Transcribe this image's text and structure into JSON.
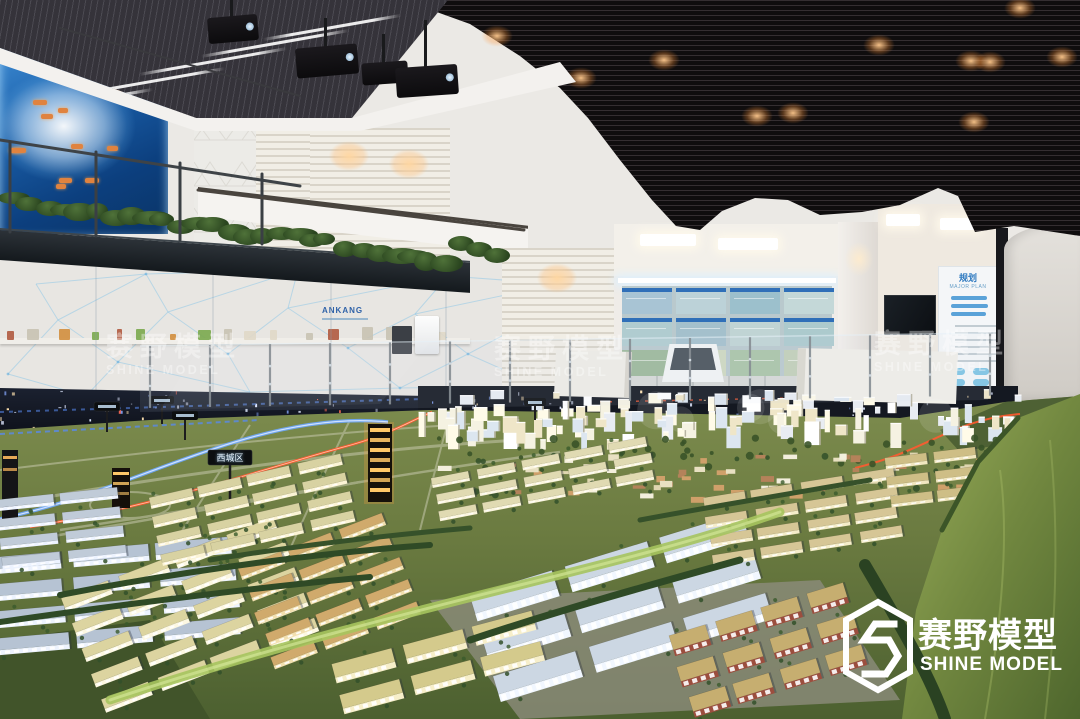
{
  "scene": {
    "description": "Exhibition hall with an illuminated city-planning scale model, mezzanine gallery, blue illuminated China map wall and Shine Model watermarks"
  },
  "watermarks": [
    {
      "zh": "赛野模型",
      "en": "SHINE MODEL"
    },
    {
      "zh": "赛野模型",
      "en": "SHINE MODEL"
    },
    {
      "zh": "赛野模型",
      "en": "SHINE MODEL"
    }
  ],
  "logo": {
    "zh": "赛野模型",
    "en": "SHINE MODEL"
  },
  "wall_text": {
    "ankang": "ANKANG"
  },
  "info_panel": {
    "title": "规划",
    "subtitle": "MAJOR PLAN"
  },
  "model_signs": {
    "district": "西城区"
  },
  "colors": {
    "ceiling_black": "#0f0d0e",
    "wall_white": "#ebe9e5",
    "map_blue": "#1a5ea8",
    "tag_orange": "#e0833f",
    "led_blue": "#6fa8ff",
    "led_red": "#ff5a30",
    "terrain_olive": "#6a7a40",
    "hill_green": "#96aa58"
  },
  "model": {
    "dot_palette": [
      "#dfe8ff",
      "#dfe8ff",
      "#dfe8ff",
      "#dfe8ff",
      "#ffe2b0",
      "#ffe2b0",
      "#86a8ff",
      "#ff6a55"
    ],
    "city_palette": [
      "#f5f2e2",
      "#fffbe8",
      "#e8ecf2",
      "#dce6f0",
      "#efe6c8",
      "#ffffff"
    ],
    "sub_palette": [
      "#e8e0c2",
      "#cfa06a",
      "#b4825a",
      "#f2eedc",
      "#dfd6b0"
    ],
    "shelf_palette": [
      "#7aa84e",
      "#d28e3e",
      "#5f8cc0",
      "#c8c2b2",
      "#b05a40",
      "#e0d8c8"
    ],
    "blocks": [
      {
        "x": -15,
        "y": 558,
        "rot": -5,
        "rows": 4,
        "cols": 3,
        "bw": 76,
        "bh": 12,
        "gx": 10,
        "gy": 10,
        "roof": "#b6c3d3",
        "wall": "#edf3fe"
      },
      {
        "x": 62,
        "y": 598,
        "rot": -21,
        "rows": 5,
        "cols": 4,
        "bw": 50,
        "bh": 10,
        "gx": 9,
        "gy": 13,
        "roof": "#dcd4a0",
        "wall": "#fdf8e2"
      },
      {
        "x": 238,
        "y": 568,
        "rot": -21,
        "rows": 5,
        "cols": 3,
        "bw": 46,
        "bh": 9,
        "gx": 8,
        "gy": 11,
        "roof": "#d0aa6c",
        "wall": "#f2e0b0"
      },
      {
        "x": 148,
        "y": 498,
        "rot": -13,
        "rows": 4,
        "cols": 4,
        "bw": 44,
        "bh": 8,
        "gx": 7,
        "gy": 8,
        "roof": "#d8d2a2",
        "wall": "#fcf4d6"
      },
      {
        "x": -5,
        "y": 500,
        "rot": -6,
        "rows": 4,
        "cols": 2,
        "bw": 58,
        "bh": 8,
        "gx": 8,
        "gy": 8,
        "roof": "#c0cbd8",
        "wall": "#edf3ff"
      },
      {
        "x": 432,
        "y": 478,
        "rot": -11,
        "rows": 3,
        "cols": 5,
        "bw": 38,
        "bh": 7,
        "gx": 7,
        "gy": 7,
        "roof": "#e0dab2",
        "wall": "#faf4dc"
      },
      {
        "x": 468,
        "y": 596,
        "rot": -17,
        "rows": 3,
        "cols": 3,
        "bw": 86,
        "bh": 19,
        "gx": 14,
        "gy": 15,
        "roof": "#ccd7e3",
        "wall": "#f1f7ff"
      },
      {
        "x": 668,
        "y": 636,
        "rot": -17,
        "rows": 3,
        "cols": 4,
        "bw": 38,
        "bh": 15,
        "gx": 10,
        "gy": 11,
        "roof": "#c6ae70",
        "wall": "#9c4e3e"
      },
      {
        "x": 702,
        "y": 498,
        "rot": -9,
        "rows": 4,
        "cols": 4,
        "bw": 42,
        "bh": 8,
        "gx": 8,
        "gy": 8,
        "roof": "#d6c696",
        "wall": "#f5edca"
      },
      {
        "x": 332,
        "y": 664,
        "rot": -15,
        "rows": 2,
        "cols": 3,
        "bw": 62,
        "bh": 14,
        "gx": 10,
        "gy": 12,
        "roof": "#d4ca8c",
        "wall": "#f7efca"
      },
      {
        "x": 884,
        "y": 458,
        "rot": -7,
        "rows": 3,
        "cols": 2,
        "bw": 42,
        "bh": 8,
        "gx": 8,
        "gy": 8,
        "roof": "#cebe86",
        "wall": "#f1e7c0"
      }
    ]
  }
}
